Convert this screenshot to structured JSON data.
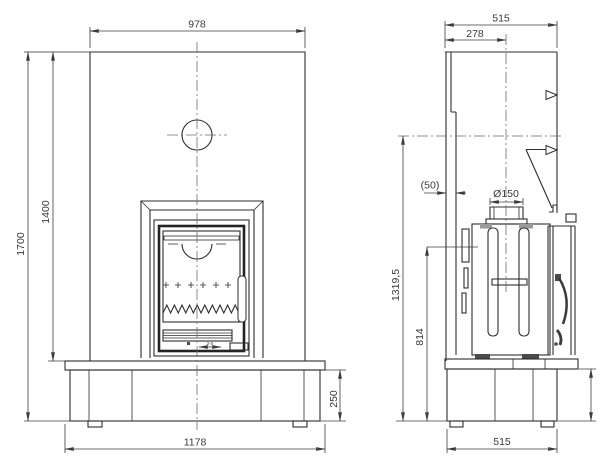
{
  "drawing_type": "fireplace technical drawing, front and side elevation",
  "front_view": {
    "labels": {
      "width_top": "978",
      "height_total": "1700",
      "height_to_bench": "1400",
      "plinth_height": "250",
      "base_width": "1178",
      "insert_micro_dim": "2-0"
    }
  },
  "side_view": {
    "labels": {
      "depth_top": "515",
      "flue_center_offset": "278",
      "rear_clearance": "(50)",
      "flue_diameter": "Ø150",
      "flue_center_height": "1319,5",
      "body_height": "814",
      "base_depth": "515"
    }
  },
  "colors": {
    "background": "#ffffff",
    "object_line": "#2e2e2e",
    "dimension_line": "#3c3c3c",
    "centerline": "#6b6b6b",
    "shading": "#9a9a9a"
  }
}
